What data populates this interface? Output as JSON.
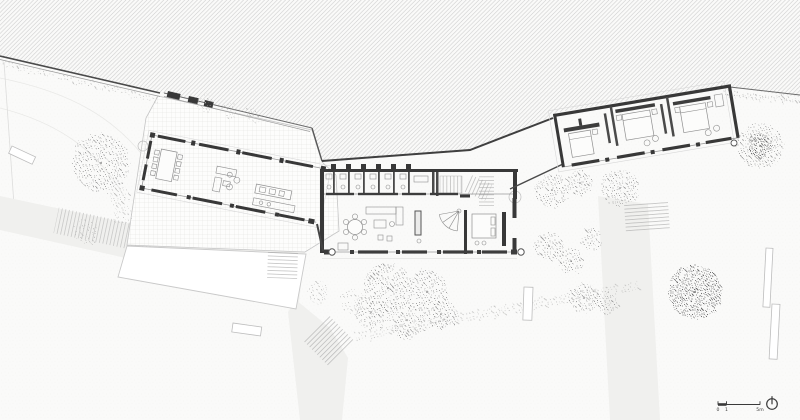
{
  "scale_bar": {
    "tick_labels": [
      "0",
      "1",
      "5m"
    ]
  },
  "icons": {
    "north_arrow": "north-arrow-icon",
    "scale_bar": "scale-bar"
  },
  "colors": {
    "paper": "#fafaf9",
    "ink": "#3a3a3a",
    "wall": "#383838",
    "hatch": "#c8c8c8",
    "grid": "#dcdcdd",
    "path": "#f0f0ee",
    "stipple": "#8f8f8f",
    "pool": "#ffffff"
  }
}
